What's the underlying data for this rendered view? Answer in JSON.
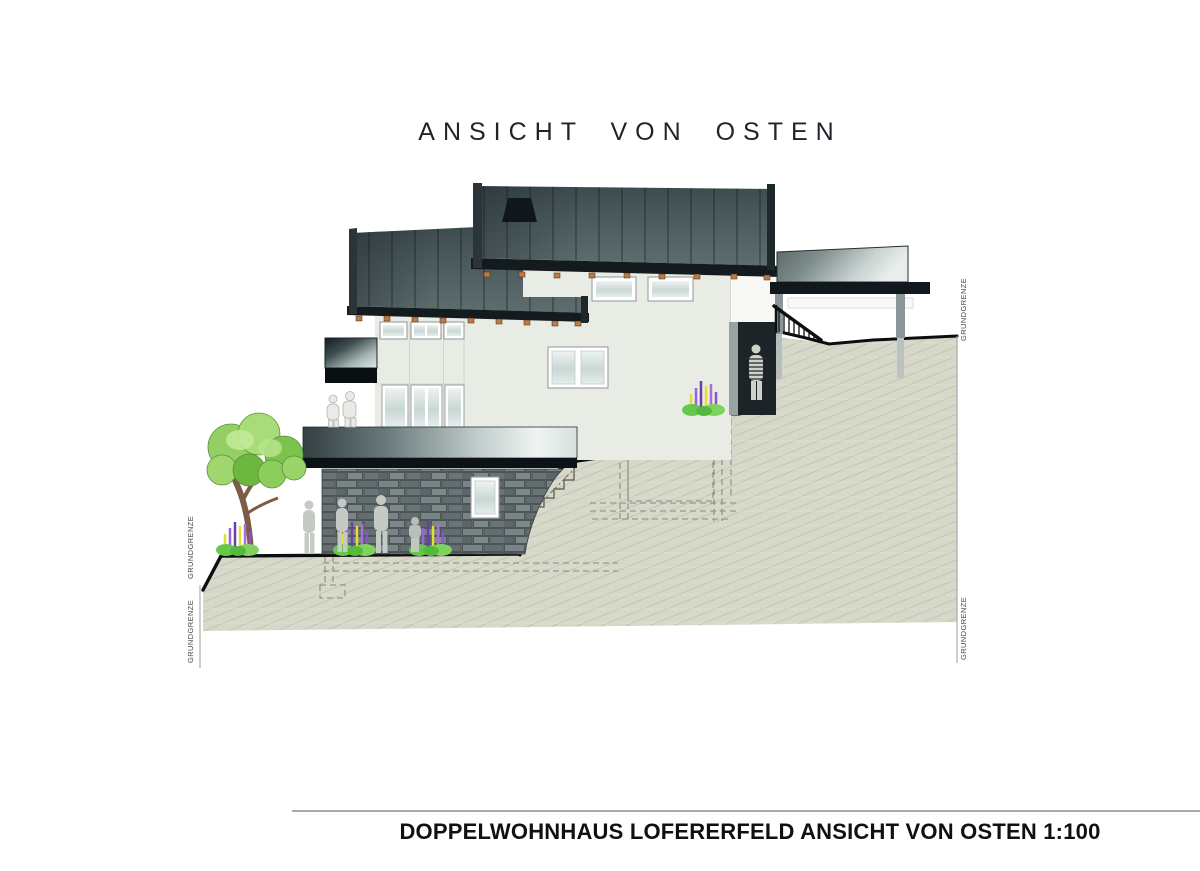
{
  "title": "ANSICHT VON OSTEN",
  "boundary": {
    "label": "GRUNDGRENZE"
  },
  "footer": {
    "label": "DOPPELWOHNHAUS LOFERERFELD ANSICHT VON OSTEN 1:100"
  },
  "colors": {
    "roof_dark": "#3d4b4e",
    "roof_light": "#5e6d6e",
    "eave_band": "#141b1e",
    "rafter_accent": "#bf7a44",
    "facade": "#e9ece5",
    "terrain_fill": "#d7d8c9",
    "terrain_hatch": "#c3c5b2",
    "stone_wall": "#6d7779",
    "passage_dark": "#1d2427",
    "plant_green": "#7cc24e",
    "plant_purple": "#9a63d8",
    "plant_yellow": "#e3dd3a",
    "person_silhouette": "#c5cac4"
  }
}
